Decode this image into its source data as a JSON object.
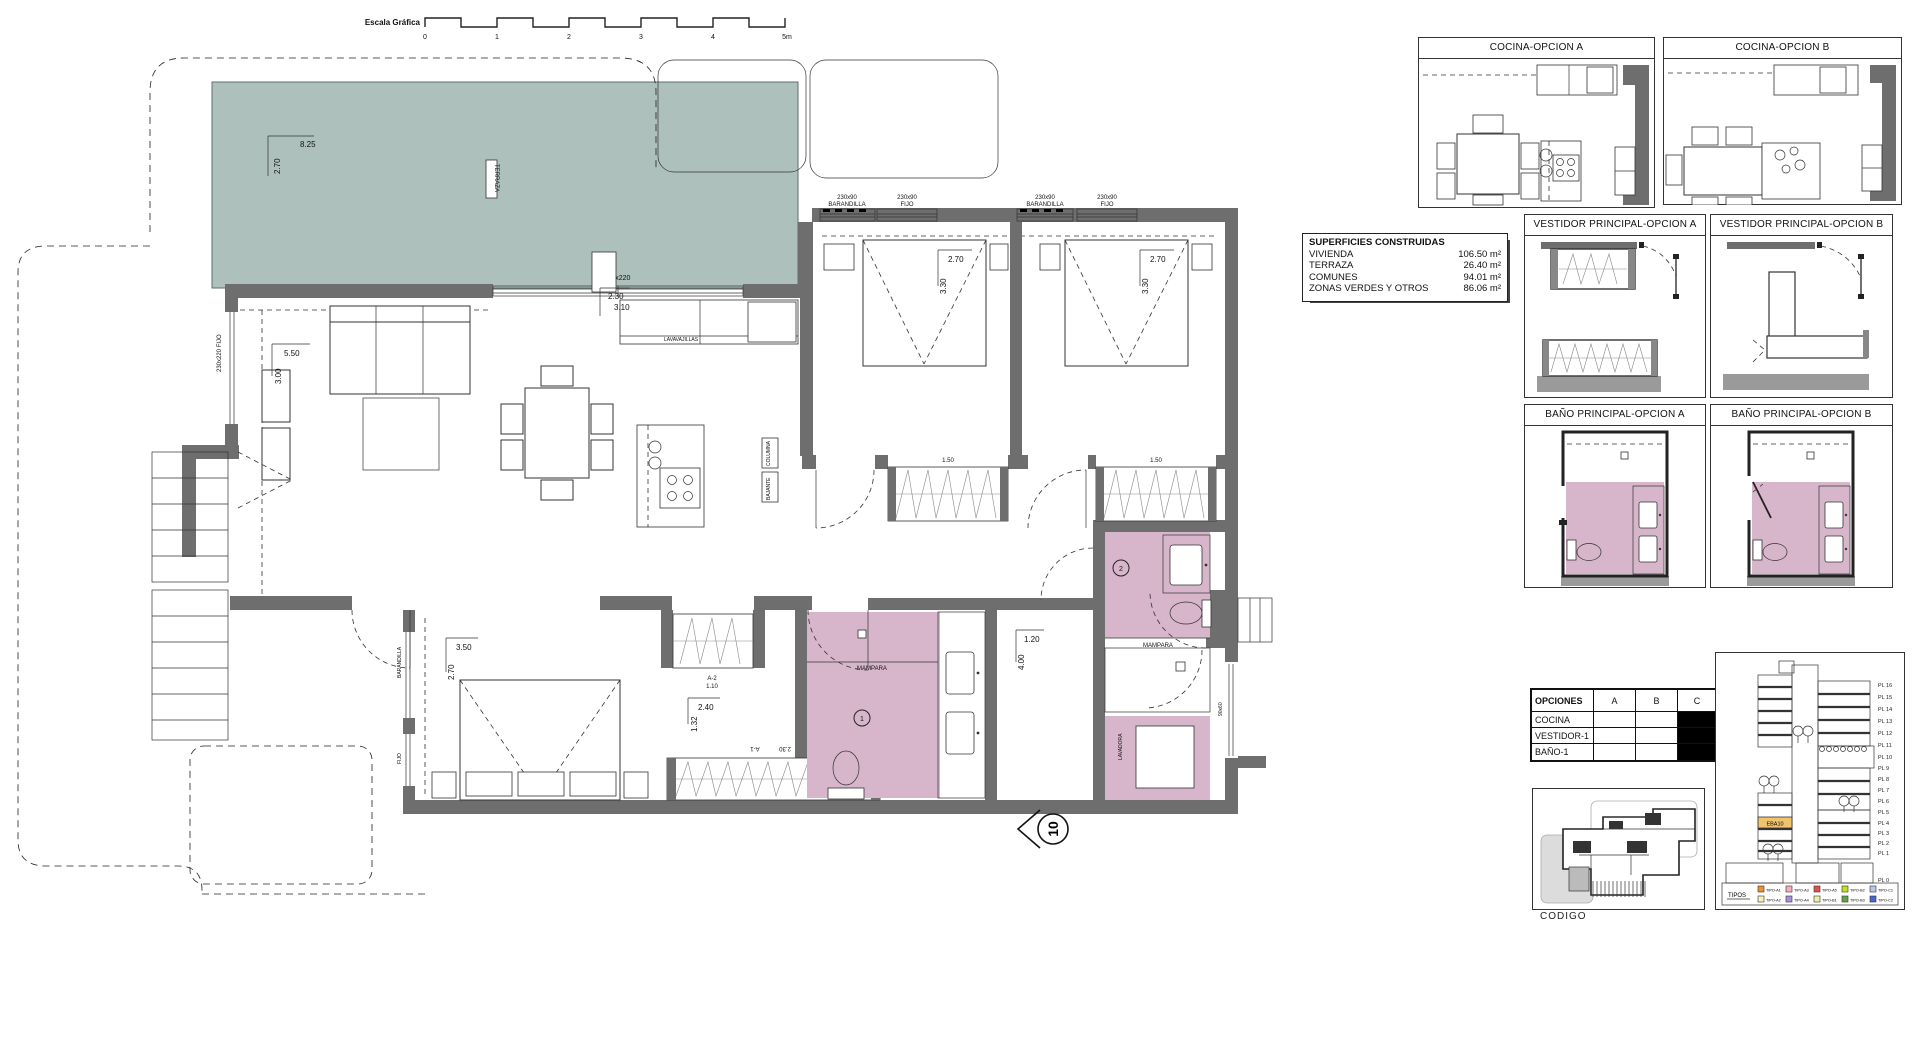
{
  "colors": {
    "wall": "#6e6e6e",
    "terrace": "#adc0bb",
    "bath": "#d7b6cc",
    "highlight": "#f0c36d",
    "base_gray": "#9a9a9a"
  },
  "plan": {
    "scale_ticks": [
      "0",
      "1",
      "2",
      "3",
      "4",
      "5m"
    ],
    "labels": {
      "escala": "Escala Gráfica",
      "terraza": "TERRAZA",
      "dim_8_25": "8.25",
      "dim_2_70t": "2.70",
      "win_230x220": "230x220",
      "win_230x220_fijo": "230x220 FIJO",
      "win_230x90": "230x90",
      "barandilla": "BARANDILLA",
      "fijo": "FIJO",
      "dim_5_50": "5.50",
      "dim_3_00": "3.00",
      "dim_2_30": "2.30",
      "dim_3_10": "3.10",
      "dim_2_70b": "2.70",
      "dim_3_30": "3.30",
      "dim_1_50": "1.50",
      "dim_3_50": "3.50",
      "dim_2_70c": "2.70",
      "dim_2_40": "2.40",
      "dim_1_32": "1.32",
      "dim_1_20": "1.20",
      "dim_4_00": "4.00",
      "ward_a2": "A-2",
      "ward_a2_w": "1.10",
      "ward_a1": "A-1",
      "ward_a1_w": "2.30",
      "mampara": "MAMPARA",
      "lavadora": "LAVADORA",
      "lavavajillas": "LAVAVAJILLAS",
      "columna": "COLUMNA",
      "bajante": "BAJANTE",
      "shower_90x60": "90x60",
      "bath1_num": "1",
      "bath2_num": "2",
      "unit_num": "10"
    }
  },
  "surfaces": {
    "title": "SUPERFICIES CONSTRUIDAS",
    "rows": [
      {
        "label": "VIVIENDA",
        "value": "106.50 m²"
      },
      {
        "label": "TERRAZA",
        "value": "26.40 m²"
      },
      {
        "label": "COMUNES",
        "value": "94.01 m²"
      },
      {
        "label": "ZONAS VERDES Y OTROS",
        "value": "86.06 m²"
      }
    ]
  },
  "panels": {
    "cocina_a": "COCINA-OPCION A",
    "cocina_b": "COCINA-OPCION B",
    "vestidor_a": "VESTIDOR PRINCIPAL-OPCION A",
    "vestidor_b": "VESTIDOR PRINCIPAL-OPCION B",
    "bano_a": "BAÑO PRINCIPAL-OPCION A",
    "bano_b": "BAÑO PRINCIPAL-OPCION B"
  },
  "opciones": {
    "headers": [
      "OPCIONES",
      "A",
      "B",
      "C"
    ],
    "rows": [
      "COCINA",
      "VESTIDOR-1",
      "BAÑO-1"
    ]
  },
  "section": {
    "levels": [
      "PL 16",
      "PL 15",
      "PL 14",
      "PL 13",
      "PL 12",
      "PL 11",
      "PL 10",
      "PL 9",
      "PL 8",
      "PL 7",
      "PL 6",
      "PL 5",
      "PL 4",
      "PL 3",
      "PL 2",
      "PL 1",
      "PL 0"
    ],
    "highlight": "EBA10",
    "legend_title": "TIPOS",
    "legend": [
      {
        "name": "TIPO-A1",
        "color": "#f0912e"
      },
      {
        "name": "TIPO-A3",
        "color": "#f7aebe"
      },
      {
        "name": "TIPO-A5",
        "color": "#e84f45"
      },
      {
        "name": "TIPO-B2",
        "color": "#c6df25"
      },
      {
        "name": "TIPO-C1",
        "color": "#b3c9e6"
      },
      {
        "name": "TIPO-A2",
        "color": "#f8f0b4"
      },
      {
        "name": "TIPO-A4",
        "color": "#a78fdd"
      },
      {
        "name": "TIPO-B1",
        "color": "#eef0a6"
      },
      {
        "name": "TIPO-B3",
        "color": "#63a447"
      },
      {
        "name": "TIPO-C2",
        "color": "#4766d6"
      }
    ]
  },
  "keyplan": {
    "caption": "CODIGO"
  }
}
